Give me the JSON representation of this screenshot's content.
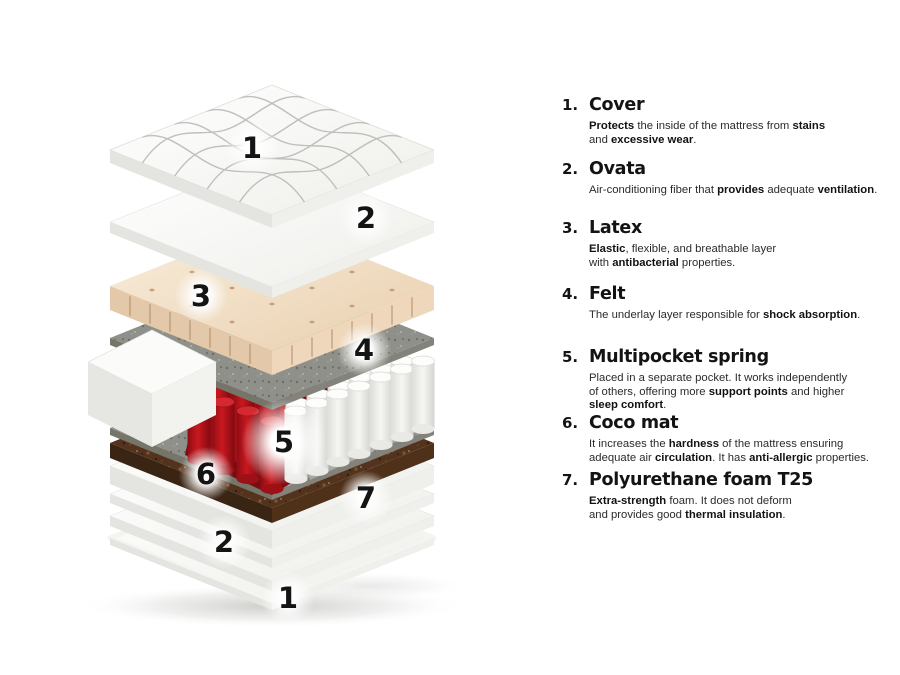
{
  "legend": {
    "items": [
      {
        "number": "1.",
        "title": "Cover",
        "desc": [
          {
            "t": "Protects",
            "b": true
          },
          {
            "t": " the inside of the mattress from ",
            "b": false
          },
          {
            "t": "stains",
            "b": true
          },
          {
            "t": "\nand ",
            "b": false
          },
          {
            "t": "excessive wear",
            "b": true
          },
          {
            "t": ".",
            "b": false
          }
        ]
      },
      {
        "number": "2.",
        "title": "Ovata",
        "desc": [
          {
            "t": "Air-conditioning fiber that ",
            "b": false
          },
          {
            "t": "provides",
            "b": true
          },
          {
            "t": " adequate ",
            "b": false
          },
          {
            "t": "ventilation",
            "b": true
          },
          {
            "t": ".",
            "b": false
          }
        ]
      },
      {
        "number": "3.",
        "title": "Latex",
        "desc": [
          {
            "t": "Elastic",
            "b": true
          },
          {
            "t": ", flexible, and breathable layer\nwith ",
            "b": false
          },
          {
            "t": "antibacterial",
            "b": true
          },
          {
            "t": " properties.",
            "b": false
          }
        ]
      },
      {
        "number": "4.",
        "title": "Felt",
        "desc": [
          {
            "t": "The underlay layer responsible for ",
            "b": false
          },
          {
            "t": "shock absorption",
            "b": true
          },
          {
            "t": ".",
            "b": false
          }
        ]
      },
      {
        "number": "5.",
        "title": "Multipocket spring",
        "desc": [
          {
            "t": "Placed in a separate pocket. It works independently\nof others, offering more ",
            "b": false
          },
          {
            "t": "support points",
            "b": true
          },
          {
            "t": " and higher\n",
            "b": false
          },
          {
            "t": "sleep comfort",
            "b": true
          },
          {
            "t": ".",
            "b": false
          }
        ]
      },
      {
        "number": "6.",
        "title": "Coco mat",
        "desc": [
          {
            "t": "It increases the ",
            "b": false
          },
          {
            "t": "hardness",
            "b": true
          },
          {
            "t": " of the mattress ensuring\nadequate air ",
            "b": false
          },
          {
            "t": "circulation",
            "b": true
          },
          {
            "t": ". It has ",
            "b": false
          },
          {
            "t": "anti-allergic",
            "b": true
          },
          {
            "t": " properties.",
            "b": false
          }
        ]
      },
      {
        "number": "7.",
        "title": "Polyurethane foam T25",
        "desc": [
          {
            "t": "Extra-strength",
            "b": true
          },
          {
            "t": " foam. It does not deform\nand provides good ",
            "b": false
          },
          {
            "t": "thermal insulation",
            "b": true
          },
          {
            "t": ".",
            "b": false
          }
        ]
      }
    ]
  },
  "diagram": {
    "labels": [
      {
        "n": "1",
        "x": 252,
        "y": 148
      },
      {
        "n": "2",
        "x": 366,
        "y": 218
      },
      {
        "n": "3",
        "x": 201,
        "y": 296
      },
      {
        "n": "4",
        "x": 364,
        "y": 350
      },
      {
        "n": "5",
        "x": 284,
        "y": 442,
        "strong": true
      },
      {
        "n": "6",
        "x": 206,
        "y": 474
      },
      {
        "n": "7",
        "x": 366,
        "y": 498
      },
      {
        "n": "2",
        "x": 224,
        "y": 542
      },
      {
        "n": "1",
        "x": 288,
        "y": 598
      }
    ],
    "colors": {
      "spring_red": "#c9181f",
      "spring_red_dark": "#820a0f",
      "felt_gray": "#90908a",
      "coco_brown": "#53331d",
      "latex_beige": "#eed7ba",
      "foam_white": "#f6f6f3",
      "text_black": "#131313"
    }
  }
}
